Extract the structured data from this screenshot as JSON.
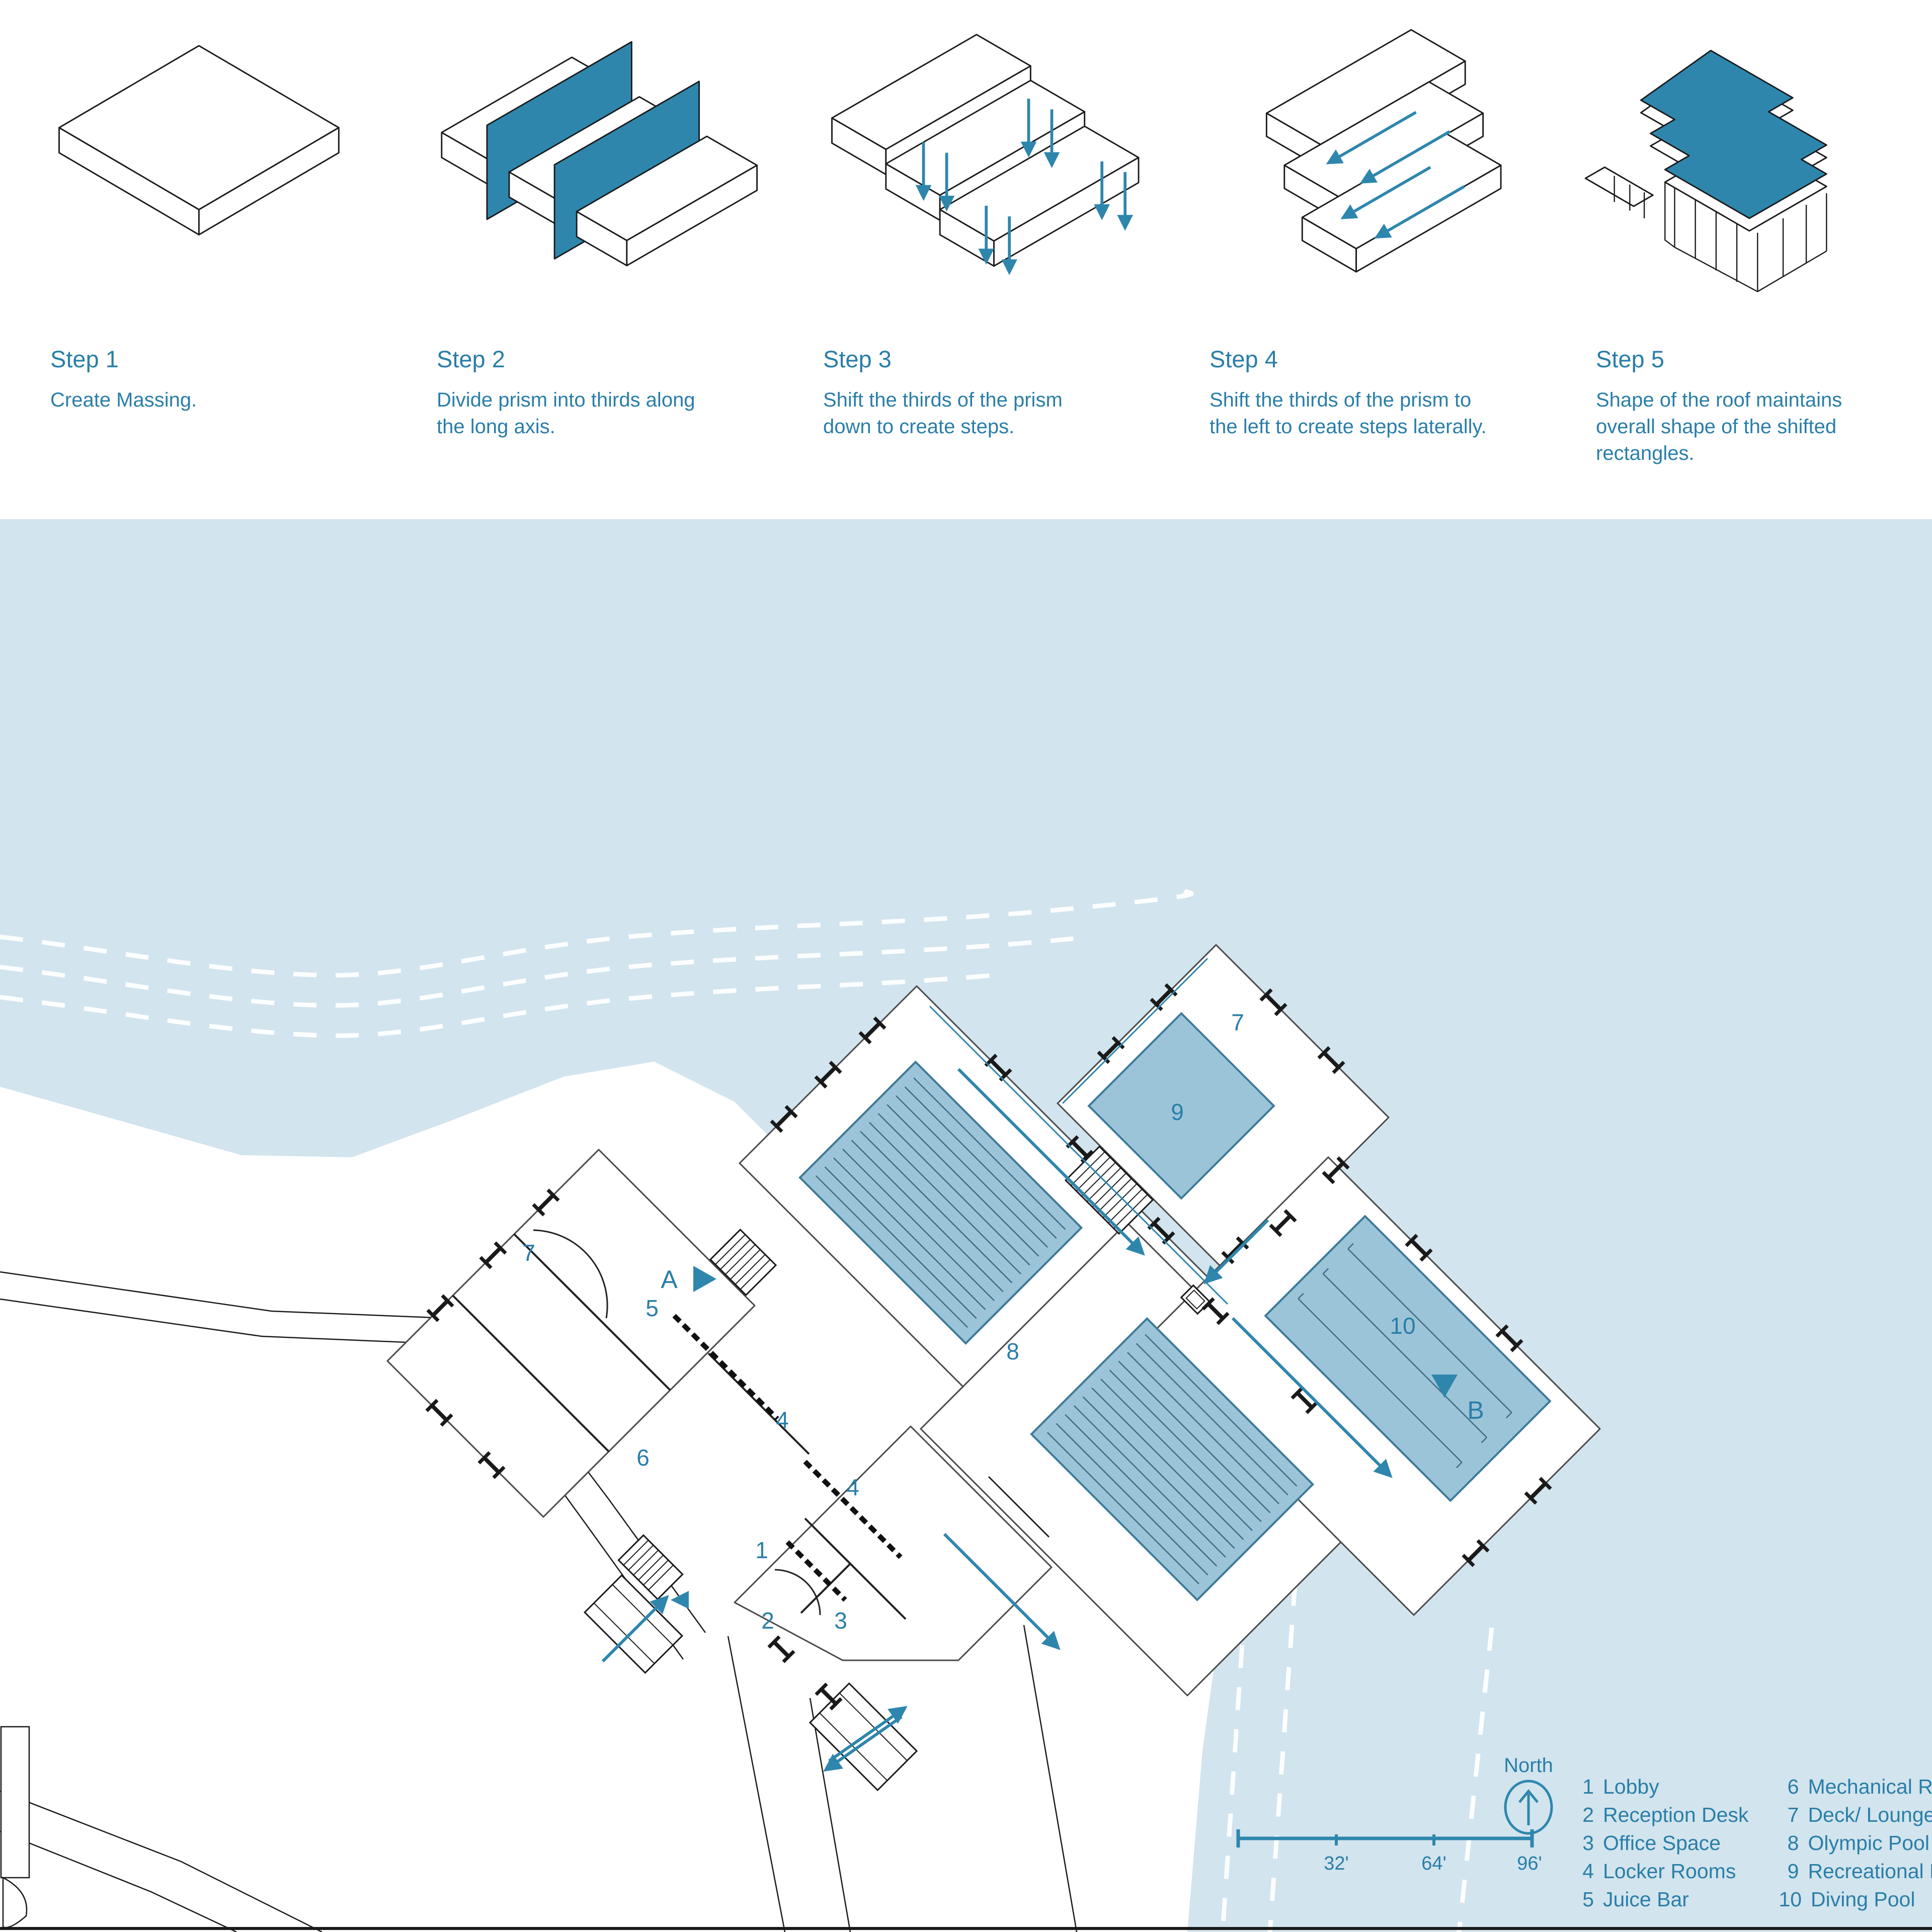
{
  "colors": {
    "accent": "#2E86AD",
    "label_text": "#2A7EA8",
    "water": "#D2E4EE",
    "pool_fill": "#9CC4D8",
    "pool_stroke": "#3D7A99",
    "line_dark": "#1a1a1a"
  },
  "steps": [
    {
      "title": "Step 1",
      "desc": "Create Massing."
    },
    {
      "title": "Step 2",
      "desc": "Divide prism into thirds along the long axis."
    },
    {
      "title": "Step 3",
      "desc": "Shift the thirds of the prism down to create steps."
    },
    {
      "title": "Step 4",
      "desc": "Shift the thirds of the prism to the left to create steps laterally."
    },
    {
      "title": "Step 5",
      "desc": "Shape of the roof maintains overall shape of the shifted rectangles."
    }
  ],
  "plan": {
    "labels": {
      "lounge_west": "7",
      "juice_bar": "5",
      "lockers_a": "4",
      "mechanical": "6",
      "lockers_b": "4",
      "lobby": "1",
      "reception": "2",
      "office": "3",
      "olympic": "8",
      "recreational": "9",
      "deck_east": "7",
      "diving": "10",
      "section_a": "A",
      "section_b": "B"
    },
    "north_label": "North",
    "scale_ticks": [
      "32'",
      "64'",
      "96'"
    ]
  },
  "legend": {
    "items1": [
      {
        "num": "1",
        "label": "Lobby"
      },
      {
        "num": "2",
        "label": "Reception Desk"
      },
      {
        "num": "3",
        "label": "Office Space"
      },
      {
        "num": "4",
        "label": "Locker Rooms"
      },
      {
        "num": "5",
        "label": "Juice Bar"
      }
    ],
    "items2": [
      {
        "num": "6",
        "label": "Mechanical Rooms"
      },
      {
        "num": "7",
        "label": "Deck/ Lounge Area"
      },
      {
        "num": "8",
        "label": "Olympic Pool"
      },
      {
        "num": "9",
        "label": "Recreational Pool"
      },
      {
        "num": "10",
        "label": "Diving Pool"
      }
    ]
  }
}
